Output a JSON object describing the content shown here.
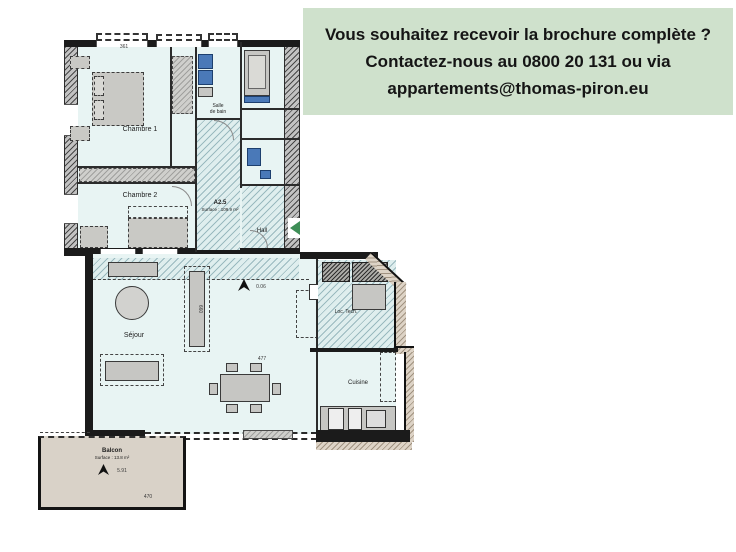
{
  "banner": {
    "line1": "Vous souhaitez recevoir la brochure complète ?",
    "line2": "Contactez-nous au 0800 20 131 ou via",
    "line3": "appartements@thomas-piron.eu"
  },
  "plan": {
    "unit": {
      "code": "A2.5",
      "surface": "Surface : 109.9 m²"
    },
    "rooms": {
      "chambre1": "Chambre 1",
      "chambre2": "Chambre 2",
      "salle_de_bain_l1": "Salle",
      "salle_de_bain_l2": "de bain",
      "hall": "Hall",
      "sejour": "Séjour",
      "cuisine": "Cuisine",
      "loc_tech": "Loc. Tech.",
      "balcon": "Balcon",
      "balcon_surface": "Surface : 13.8 m²"
    },
    "levels": {
      "sejour_level": "0.06",
      "balcon_level": "5.91"
    },
    "dimensions": {
      "top": "361",
      "table": "477",
      "balcon_width": "470",
      "cabinet": "660"
    },
    "colors": {
      "banner_green": "#cfe1cc",
      "wall_black": "#1b1b1b",
      "room_fill": "#e8f4f3",
      "hatch_blue": "#608e98",
      "balcony_fill": "#d9d2c8",
      "exterior_band": "#ddd3c6",
      "fixture_blue": "#4a79b8",
      "entrance_green": "#3e8e57",
      "furniture_gray": "#c9c9c5"
    }
  }
}
